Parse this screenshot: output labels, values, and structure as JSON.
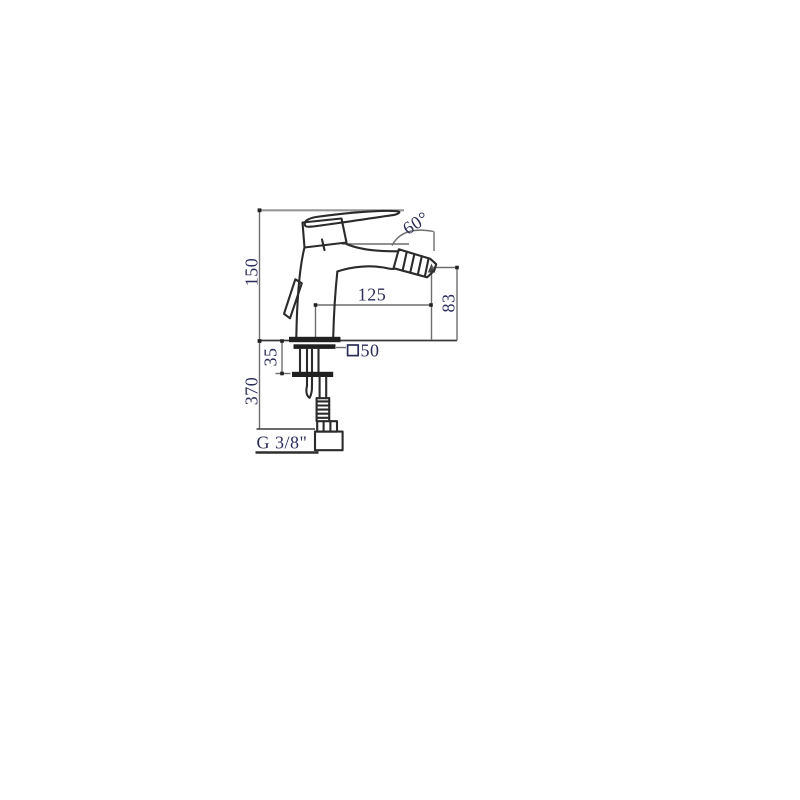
{
  "page": {
    "background": "#ffffff"
  },
  "drawing": {
    "subject": "Single-lever bidet mixer faucet — dimensional side-view technical drawing",
    "units": "mm",
    "colors": {
      "sketch_line": "#2b2b2b",
      "dimension_line": "#6e6e6e",
      "label_text": "#2b2e58"
    },
    "labels": {
      "height_above_deck": "150",
      "length_below_deck": "370",
      "deck_thickness": "35",
      "spout_reach": "125",
      "outlet_height": "83",
      "outlet_angle": "60°",
      "base_size": "50",
      "thread": "G 3/8\""
    }
  }
}
